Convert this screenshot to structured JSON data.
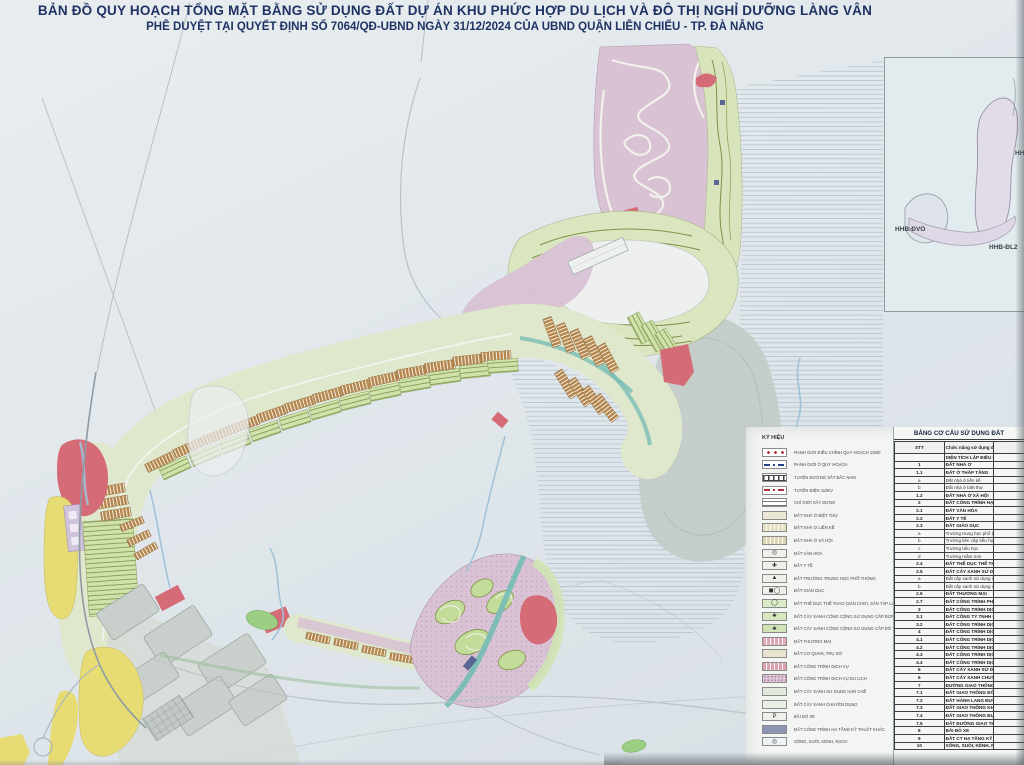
{
  "title": {
    "line1": "BẢN ĐỒ QUY HOẠCH TỔNG MẶT BẰNG SỬ DỤNG ĐẤT DỰ ÁN KHU PHỨC HỢP DU LỊCH VÀ ĐÔ THỊ NGHỈ DƯỠNG LÀNG VÂN",
    "line2": "PHÊ DUYỆT TẠI QUYẾT ĐỊNH SỐ 7064/QĐ-UBND NGÀY 31/12/2024 CỦA UBND QUẬN LIÊN CHIỂU - TP. ĐÀ NẴNG"
  },
  "inset": {
    "title": "SƠ ĐỒ PHÂN Ô QUY HOẠCH",
    "labels": [
      "HHB-ĐVO",
      "HHB-ĐL2",
      "HH"
    ]
  },
  "legend": {
    "title": "KÝ HIỆU",
    "items": [
      {
        "label": "RANH GIỚI ĐIỀU CHỈNH QUY HOẠCH 1/500",
        "kind": "line-dots",
        "color": "#b03040"
      },
      {
        "label": "RANH GIỚI Ô QUY HOẠCH",
        "kind": "line-dashdot",
        "color": "#27408b"
      },
      {
        "label": "TUYẾN ĐƯỜNG SẮT BẮC NAM",
        "kind": "rail",
        "color": "#444444"
      },
      {
        "label": "TUYẾN ĐIỆN 110KV",
        "kind": "line-dashdot",
        "color": "#b03040"
      },
      {
        "label": "CHỈ GIỚI XÂY DỰNG",
        "kind": "parallel",
        "color": "#555555"
      },
      {
        "label": "ĐẤT NHÀ Ở BIỆT THỰ",
        "kind": "fill",
        "color": "#eae8d4"
      },
      {
        "label": "ĐẤT NHÀ Ở LIỀN KỀ",
        "kind": "fill-hatch",
        "color": "#e5dfc2"
      },
      {
        "label": "ĐẤT NHÀ Ở XÃ HỘI",
        "kind": "fill-hatch",
        "color": "#ddd6b2"
      },
      {
        "label": "ĐẤT VĂN HÓA",
        "kind": "symbol",
        "color": "#f0f0ea",
        "symbol": "◎"
      },
      {
        "label": "ĐẤT Y TẾ",
        "kind": "symbol",
        "color": "#f0f0ea",
        "symbol": "✚"
      },
      {
        "label": "ĐẤT TRƯỜNG TRUNG HỌC PHỔ THÔNG",
        "kind": "symbol",
        "color": "#f0f0ea",
        "symbol": "▲"
      },
      {
        "label": "ĐẤT GIÁO DỤC",
        "kind": "symbol",
        "color": "#f0f0ea",
        "symbol": "◼◯"
      },
      {
        "label": "ĐẤT THỂ DỤC THỂ THAO (SÂN CHƠI, SÂN TẬP LUYỆN)",
        "kind": "symbol",
        "color": "#dcebc8",
        "symbol": "◯"
      },
      {
        "label": "ĐẤT CÂY XANH CÔNG CỘNG SỬ DỤNG CẤP ĐƠN VỊ Ở",
        "kind": "symbol",
        "color": "#d7e8c0",
        "symbol": "♣"
      },
      {
        "label": "ĐẤT CÂY XANH CÔNG CỘNG SỬ DỤNG CẤP ĐÔ THỊ",
        "kind": "symbol",
        "color": "#cfe3b4",
        "symbol": "♣"
      },
      {
        "label": "ĐẤT THƯƠNG MẠI",
        "kind": "fill-hatch",
        "color": "#e2a7b4"
      },
      {
        "label": "ĐẤT CƠ QUAN, TRỤ SỞ",
        "kind": "fill",
        "color": "#e7e3cf"
      },
      {
        "label": "ĐẤT CÔNG TRÌNH DỊCH VỤ",
        "kind": "fill-hatch",
        "color": "#dfa3ae"
      },
      {
        "label": "ĐẤT CÔNG TRÌNH DỊCH VỤ DU LỊCH",
        "kind": "fill-dots",
        "color": "#e0c6d8"
      },
      {
        "label": "ĐẤT CÂY XANH SỬ DỤNG HẠN CHẾ",
        "kind": "fill",
        "color": "#dfeadd"
      },
      {
        "label": "ĐẤT CÂY XANH CHUYÊN DỤNG",
        "kind": "fill",
        "color": "#e9efe4"
      },
      {
        "label": "BÃI ĐỖ XE",
        "kind": "symbol",
        "color": "#eef0ec",
        "symbol": "P"
      },
      {
        "label": "ĐẤT CÔNG TRÌNH HẠ TẦNG KỸ THUẬT KHÁC",
        "kind": "fill",
        "color": "#8d95b5"
      },
      {
        "label": "SÔNG, SUỐI, KÊNH, RẠCH",
        "kind": "symbol",
        "color": "#eef3f5",
        "symbol": "◎"
      }
    ]
  },
  "land_table": {
    "title": "BẢNG CƠ CẤU SỬ DỤNG ĐẤT",
    "columns": [
      "STT",
      "Chức năng sử dụng đất"
    ],
    "rows": [
      {
        "stt": "",
        "name": "DIỆN TÍCH LẬP ĐIỀU CHỈNH QUY HOẠCH"
      },
      {
        "stt": "1",
        "name": "ĐẤT NHÀ Ở"
      },
      {
        "stt": "1.1",
        "name": "ĐẤT Ở THẤP TẦNG"
      },
      {
        "stt": "a",
        "name": "Đất nhà ở liền kề"
      },
      {
        "stt": "b",
        "name": "Đất nhà ở biệt thự"
      },
      {
        "stt": "1.2",
        "name": "ĐẤT NHÀ Ở XÃ HỘI"
      },
      {
        "stt": "2",
        "name": "ĐẤT CÔNG TRÌNH HẠ TẦNG XÃ HỘI"
      },
      {
        "stt": "2.1",
        "name": "ĐẤT VĂN HÓA"
      },
      {
        "stt": "2.2",
        "name": "ĐẤT Y TẾ"
      },
      {
        "stt": "2.3",
        "name": "ĐẤT GIÁO DỤC"
      },
      {
        "stt": "a",
        "name": "Trường trung học phổ thông"
      },
      {
        "stt": "b",
        "name": "Trường liên cấp tiểu học - trung học cơ sở"
      },
      {
        "stt": "c",
        "name": "Trường tiểu học"
      },
      {
        "stt": "d",
        "name": "Trường mầm non"
      },
      {
        "stt": "2.4",
        "name": "ĐẤT THỂ DỤC THỂ THAO"
      },
      {
        "stt": "2.5",
        "name": "ĐẤT CÂY XANH SỬ DỤNG CÔNG CỘNG"
      },
      {
        "stt": "a",
        "name": "Đất cây xanh sử dụng công cộng đơn vị ở"
      },
      {
        "stt": "b",
        "name": "Đất cây xanh sử dụng công cộng cấp đô thị"
      },
      {
        "stt": "2.6",
        "name": "ĐẤT THƯƠNG MẠI"
      },
      {
        "stt": "2.7",
        "name": "ĐẤT CÔNG TRÌNH PHÒNG CHÁY CHỮA CHÁY"
      },
      {
        "stt": "3",
        "name": "ĐẤT CÔNG TRÌNH DỊCH VỤ"
      },
      {
        "stt": "3.1",
        "name": "ĐẤT CÔNG TY TNHH CHÀM CHÀM"
      },
      {
        "stt": "3.2",
        "name": "ĐẤT CÔNG TRÌNH DỊCH VỤ KHÁC"
      },
      {
        "stt": "4",
        "name": "ĐẤT CÔNG TRÌNH DỊCH VỤ DU LỊCH"
      },
      {
        "stt": "4.1",
        "name": "ĐẤT CÔNG TRÌNH DỊCH VỤ DU LỊCH- 1"
      },
      {
        "stt": "4.2",
        "name": "ĐẤT CÔNG TRÌNH DỊCH VỤ DU LỊCH- 2"
      },
      {
        "stt": "4.3",
        "name": "ĐẤT CÔNG TRÌNH DỊCH VỤ DU LỊCH- 3"
      },
      {
        "stt": "4.4",
        "name": "ĐẤT CÔNG TRÌNH DỊCH VỤ DU LỊCH- 4"
      },
      {
        "stt": "5",
        "name": "ĐẤT CÂY XANH SỬ DỤNG HẠN CHẾ"
      },
      {
        "stt": "6",
        "name": "ĐẤT CÂY XANH CHUYÊN DỤNG"
      },
      {
        "stt": "7",
        "name": "ĐƯỜNG GIAO THÔNG"
      },
      {
        "stt": "7.1",
        "name": "ĐẤT GIAO THÔNG ĐỐI NGOẠI (QUỐC LỘ 1A)"
      },
      {
        "stt": "7.2",
        "name": "ĐẤT HÀNH LANG ĐƯỜNG BỘ"
      },
      {
        "stt": "7.3",
        "name": "ĐẤT GIAO THÔNG KHU VỰC"
      },
      {
        "stt": "7.4",
        "name": "ĐẤT GIAO THÔNG ĐƯỜNG SẮT"
      },
      {
        "stt": "7.5",
        "name": "ĐẤT ĐƯỜNG GIAO THÔNG NỘI BỘ"
      },
      {
        "stt": "8",
        "name": "BÃI ĐỖ XE"
      },
      {
        "stt": "9",
        "name": "ĐẤT CT HẠ TẦNG KỸ THUẬT KHÁC"
      },
      {
        "stt": "10",
        "name": "SÔNG, SUỐI, KÊNH, RẠCH"
      }
    ]
  },
  "colors": {
    "paper": "#e2e7ea",
    "sea_line": "#a9bdc9",
    "mauve": "#d8c2d4",
    "mauve2": "#d4bed2",
    "brown": "#b5854b",
    "green_band": "#dfe8cc",
    "green_rows": "#cfe2ac",
    "olive": "#7f9148",
    "red": "#d56b76",
    "yellow": "#e7dc74",
    "gray_block": "#c9d0cb",
    "navy": "#5b6694",
    "teal": "#79bdb5",
    "water": "#9dc2d8",
    "title_text": "#1e3263"
  }
}
